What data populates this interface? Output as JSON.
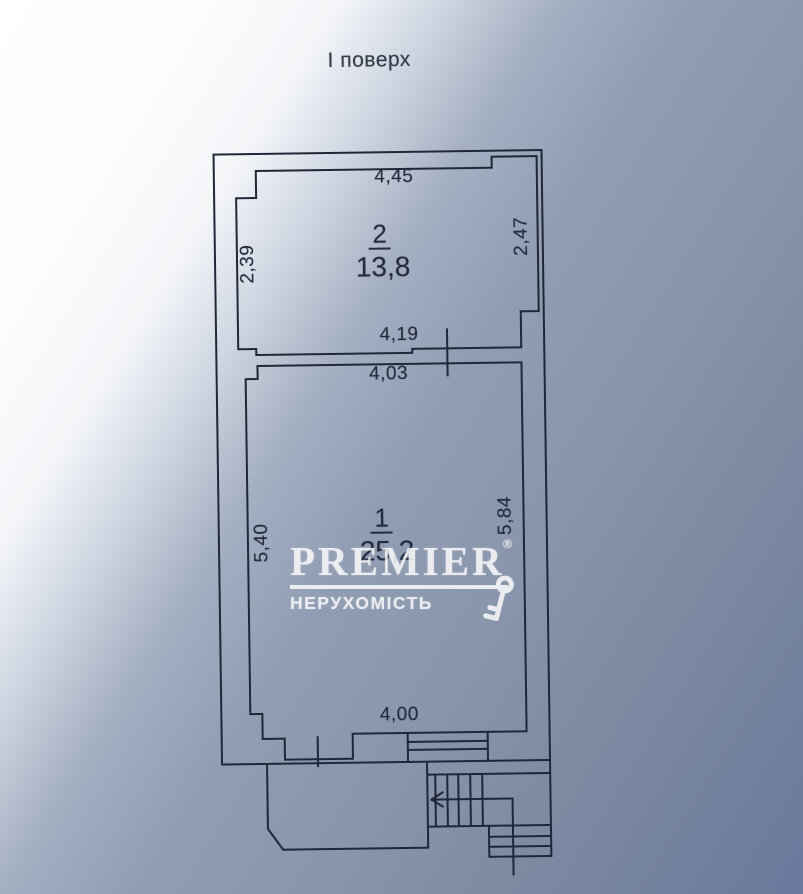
{
  "photo": {
    "floor_title": "І поверх"
  },
  "plan": {
    "rooms": [
      {
        "number": "2",
        "area": "13,8",
        "dim_top": "4,45",
        "dim_left": "2,39",
        "dim_right": "2,47",
        "dim_bottom": "4,19"
      },
      {
        "number": "1",
        "area": "25,2",
        "dim_top": "4,03",
        "dim_left": "5,40",
        "dim_right": "5,84",
        "dim_bottom": "4,00"
      }
    ]
  },
  "watermark": {
    "brand": "PREMIER",
    "registered_mark": "®",
    "subtitle": "НЕРУХОМІСТЬ",
    "icon": "key-icon"
  },
  "colors": {
    "line": "#1f2738",
    "paper_light": "#ffffff",
    "paper_mid": "#8b97ac",
    "paper_dark": "#68799c",
    "watermark": "#ffffff"
  }
}
